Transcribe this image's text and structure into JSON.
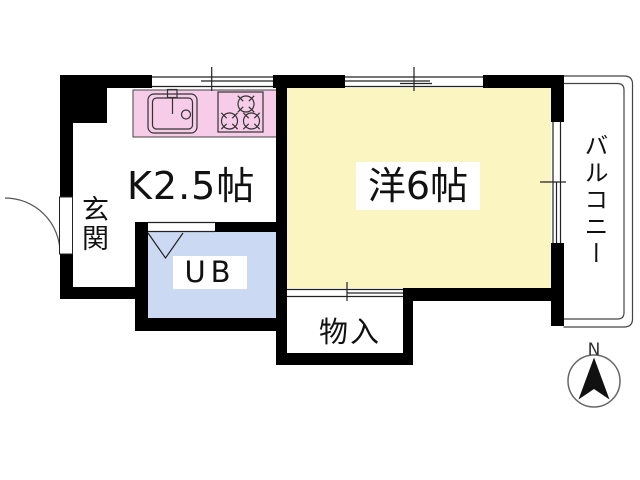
{
  "floorplan": {
    "rooms": {
      "kitchen": {
        "label": "K2.5帖"
      },
      "western_room": {
        "label": "洋6帖"
      },
      "unit_bath": {
        "label": "UB"
      },
      "entrance": {
        "label": "玄関"
      },
      "storage": {
        "label": "物入"
      },
      "balcony": {
        "label": "バルコニー"
      }
    },
    "compass": {
      "north_label": "N"
    },
    "colors": {
      "wall": "#000000",
      "line": "#222222",
      "counter": "#f7cce9",
      "western_room_floor": "#faf5c1",
      "unit_bath_floor": "#cbdaf2",
      "floor": "#ffffff"
    },
    "icons": {
      "sink": "sink-icon",
      "stove": "stove-icon",
      "north_arrow": "north-arrow-icon"
    }
  }
}
